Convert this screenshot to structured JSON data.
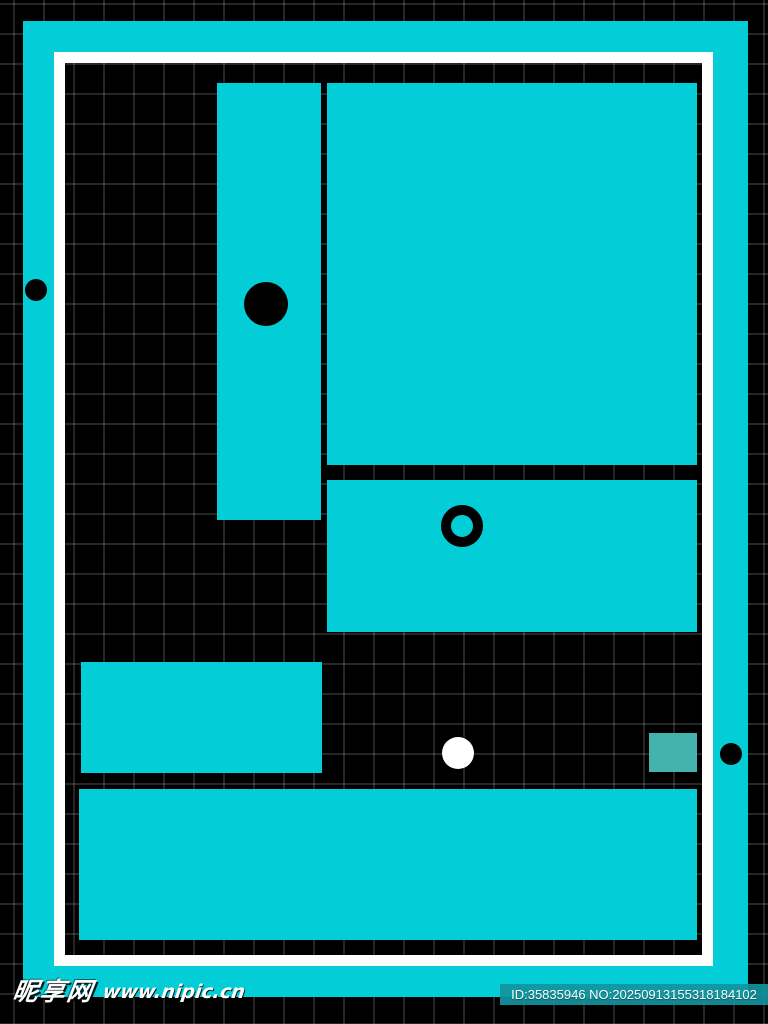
{
  "image": {
    "colors": {
      "background": "#000000",
      "grid_line": "rgba(255,255,255,0.15)",
      "cyan": "#03ced8",
      "white": "#ffffff",
      "black": "#000000",
      "muted_teal": "#44b3ae"
    },
    "grid": {
      "cell_size": 30,
      "offset_x": 13,
      "offset_y": 3
    },
    "frame": {
      "cyan_border_color": "#03ced8",
      "white_border_color": "#ffffff"
    },
    "shapes": [
      {
        "name": "tall-rect",
        "type": "rect",
        "x": 217,
        "y": 83,
        "w": 104,
        "h": 437,
        "color": "#03ced8"
      },
      {
        "name": "big-rect",
        "type": "rect",
        "x": 327,
        "y": 83,
        "w": 370,
        "h": 382,
        "color": "#03ced8"
      },
      {
        "name": "mid-rect",
        "type": "rect",
        "x": 327,
        "y": 480,
        "w": 370,
        "h": 152,
        "color": "#03ced8"
      },
      {
        "name": "small-left-rect",
        "type": "rect",
        "x": 81,
        "y": 662,
        "w": 241,
        "h": 111,
        "color": "#03ced8"
      },
      {
        "name": "bottom-wide-rect",
        "type": "rect",
        "x": 79,
        "y": 789,
        "w": 618,
        "h": 151,
        "color": "#03ced8"
      },
      {
        "name": "teal-square",
        "type": "rect",
        "x": 649,
        "y": 733,
        "w": 48,
        "h": 39,
        "color": "#44b3ae"
      },
      {
        "name": "black-dot-on-tall-rect",
        "type": "circle",
        "cx": 266,
        "cy": 304,
        "r": 22,
        "color": "#000000"
      },
      {
        "name": "black-ring-on-mid-rect",
        "type": "ring",
        "cx": 462,
        "cy": 526,
        "r": 21,
        "stroke": 10,
        "color": "#000000"
      },
      {
        "name": "white-dot",
        "type": "circle",
        "cx": 458,
        "cy": 753,
        "r": 16,
        "color": "#ffffff"
      },
      {
        "name": "left-edge-black-dot",
        "type": "circle",
        "cx": 36,
        "cy": 290,
        "r": 11,
        "color": "#000000"
      },
      {
        "name": "right-edge-black-dot",
        "type": "circle",
        "cx": 731,
        "cy": 754,
        "r": 11,
        "color": "#000000"
      }
    ]
  },
  "watermark": {
    "site_name": "昵享网",
    "site_url": "www.nipic.cn",
    "id_label": "ID:35835946 NO:20250913155318184102"
  }
}
